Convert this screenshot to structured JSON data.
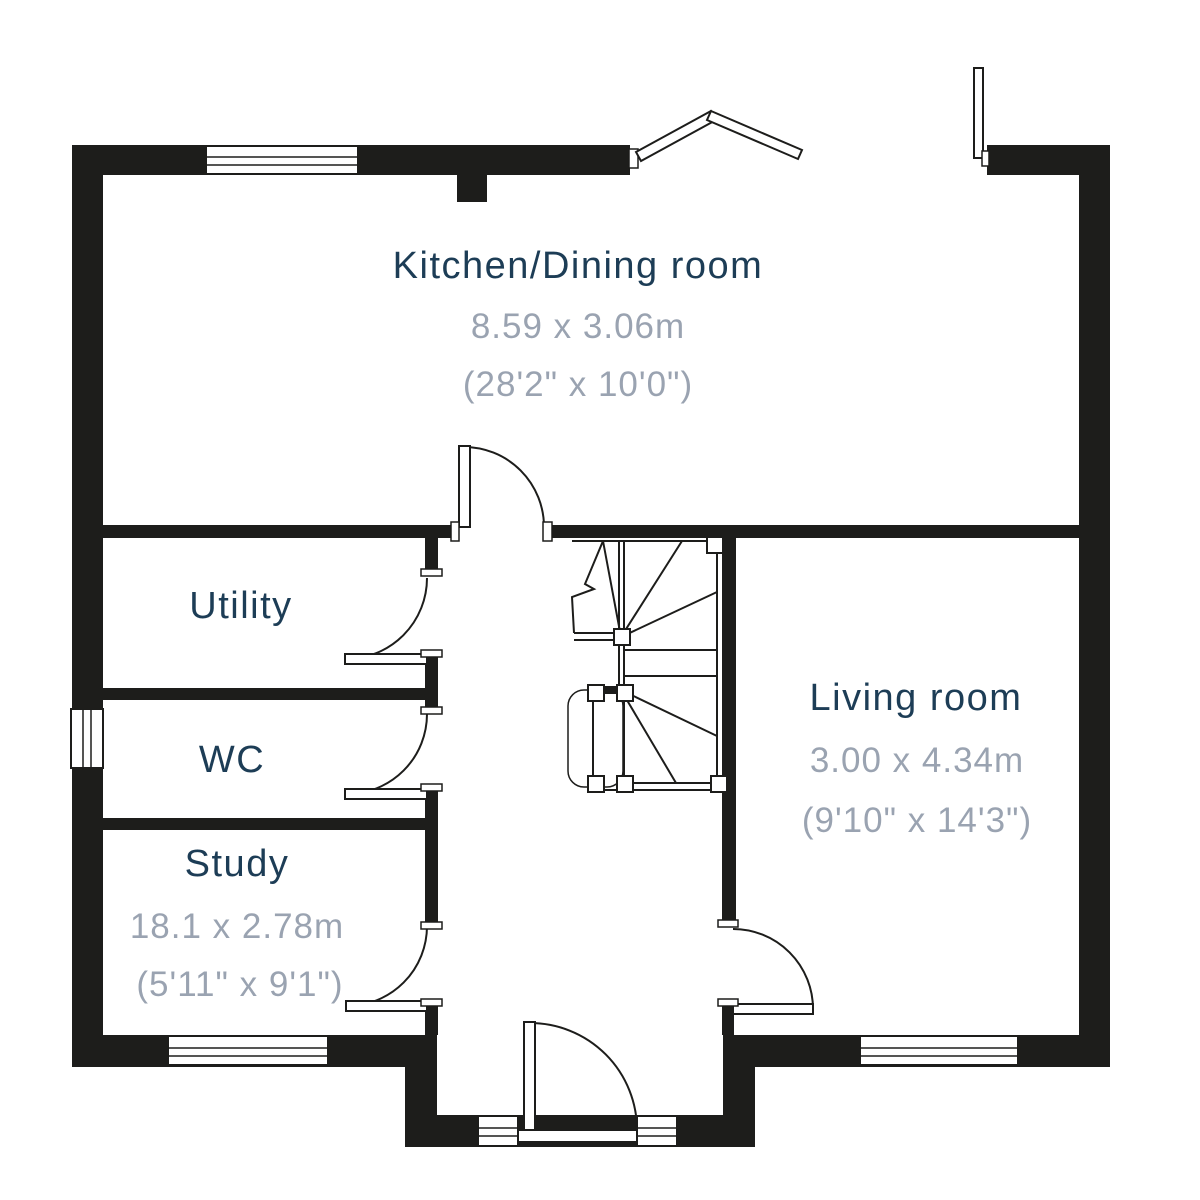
{
  "plan": {
    "type": "ground-floor-plan",
    "colors": {
      "wall": "#1d1d1b",
      "room_label": "#1d3d56",
      "dimension_label": "#9aa3b1",
      "background": "#ffffff"
    },
    "rooms": [
      {
        "name": "Kitchen/Dining room",
        "metric": "8.59 x 3.06m",
        "imperial": "(28'2\" x 10'0\")"
      },
      {
        "name": "Utility",
        "metric": "",
        "imperial": ""
      },
      {
        "name": "WC",
        "metric": "",
        "imperial": ""
      },
      {
        "name": "Study",
        "metric": "18.1 x 2.78m",
        "imperial": "(5'11\" x 9'1\")"
      },
      {
        "name": "Living room",
        "metric": "3.00 x 4.34m",
        "imperial": "(9'10\" x 14'3\")"
      }
    ]
  }
}
